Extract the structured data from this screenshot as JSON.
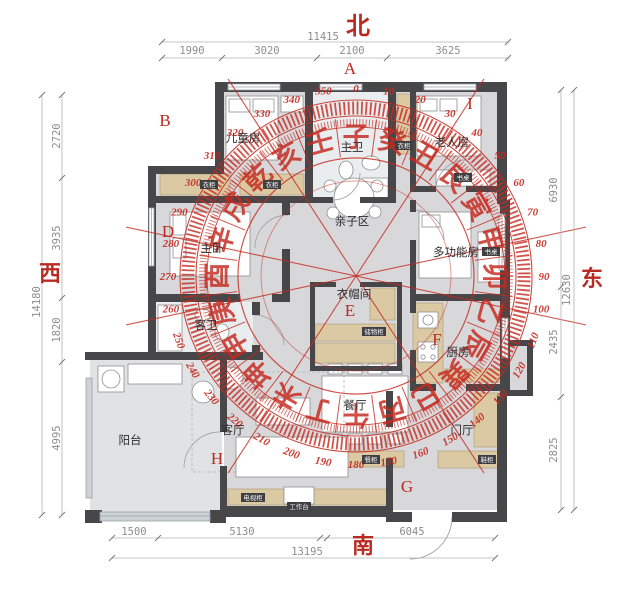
{
  "directions": {
    "north": "北",
    "south": "南",
    "west": "西",
    "east": "东"
  },
  "markers": {
    "a": "A",
    "b": "B",
    "d": "D",
    "e": "E",
    "f": "F",
    "g": "G",
    "h": "H",
    "i": "I"
  },
  "rooms": {
    "children_room": "儿童房",
    "master_bath": "主卫",
    "elder_room": "老人房",
    "master_bedroom": "主卧",
    "family_area": "亲子区",
    "cloakroom": "衣帽间",
    "multi_room": "多功能房",
    "kitchen": "厨房",
    "guest_bath": "客卫",
    "dining": "餐厅",
    "living": "客厅",
    "balcony": "阳台",
    "foyer": "门厅"
  },
  "furniture": {
    "wardrobe_a": "衣柜",
    "wardrobe_b": "衣柜",
    "wardrobe_c": "衣柜",
    "desk_elder": "书桌",
    "desk_multi": "书桌",
    "storage_cabinet": "储物柜",
    "dining_cabinet": "餐柜",
    "shoe_cabinet": "鞋柜",
    "tv_cabinet": "电视柜",
    "workbench": "工作台"
  },
  "dimensions": {
    "top": {
      "total": "11415",
      "segments": [
        "1990",
        "3020",
        "2100",
        "3625"
      ]
    },
    "left": {
      "total": "14180",
      "segments": [
        "2720",
        "3935",
        "1820",
        "4995"
      ]
    },
    "right": {
      "total": "12630",
      "segments": [
        "6930",
        "2435",
        "2825"
      ]
    },
    "bottom": {
      "total": "13195",
      "segments": [
        "1500",
        "5130",
        "6045"
      ]
    }
  },
  "compass": {
    "accent_color": "#c5291f",
    "degree_labels": [
      "0",
      "10",
      "20",
      "30",
      "40",
      "50",
      "60",
      "70",
      "80",
      "90",
      "100",
      "110",
      "120",
      "130",
      "140",
      "150",
      "160",
      "170",
      "180",
      "190",
      "200",
      "210",
      "220",
      "230",
      "240",
      "250",
      "260",
      "270",
      "280",
      "290",
      "300",
      "310",
      "320",
      "330",
      "340",
      "350"
    ],
    "mountain_chars": [
      "子",
      "癸",
      "丑",
      "艮",
      "寅",
      "甲",
      "卯",
      "乙",
      "辰",
      "巽",
      "巳",
      "丙",
      "午",
      "丁",
      "未",
      "坤",
      "申",
      "庚",
      "酉",
      "辛",
      "戌",
      "乾",
      "亥",
      "壬"
    ]
  }
}
